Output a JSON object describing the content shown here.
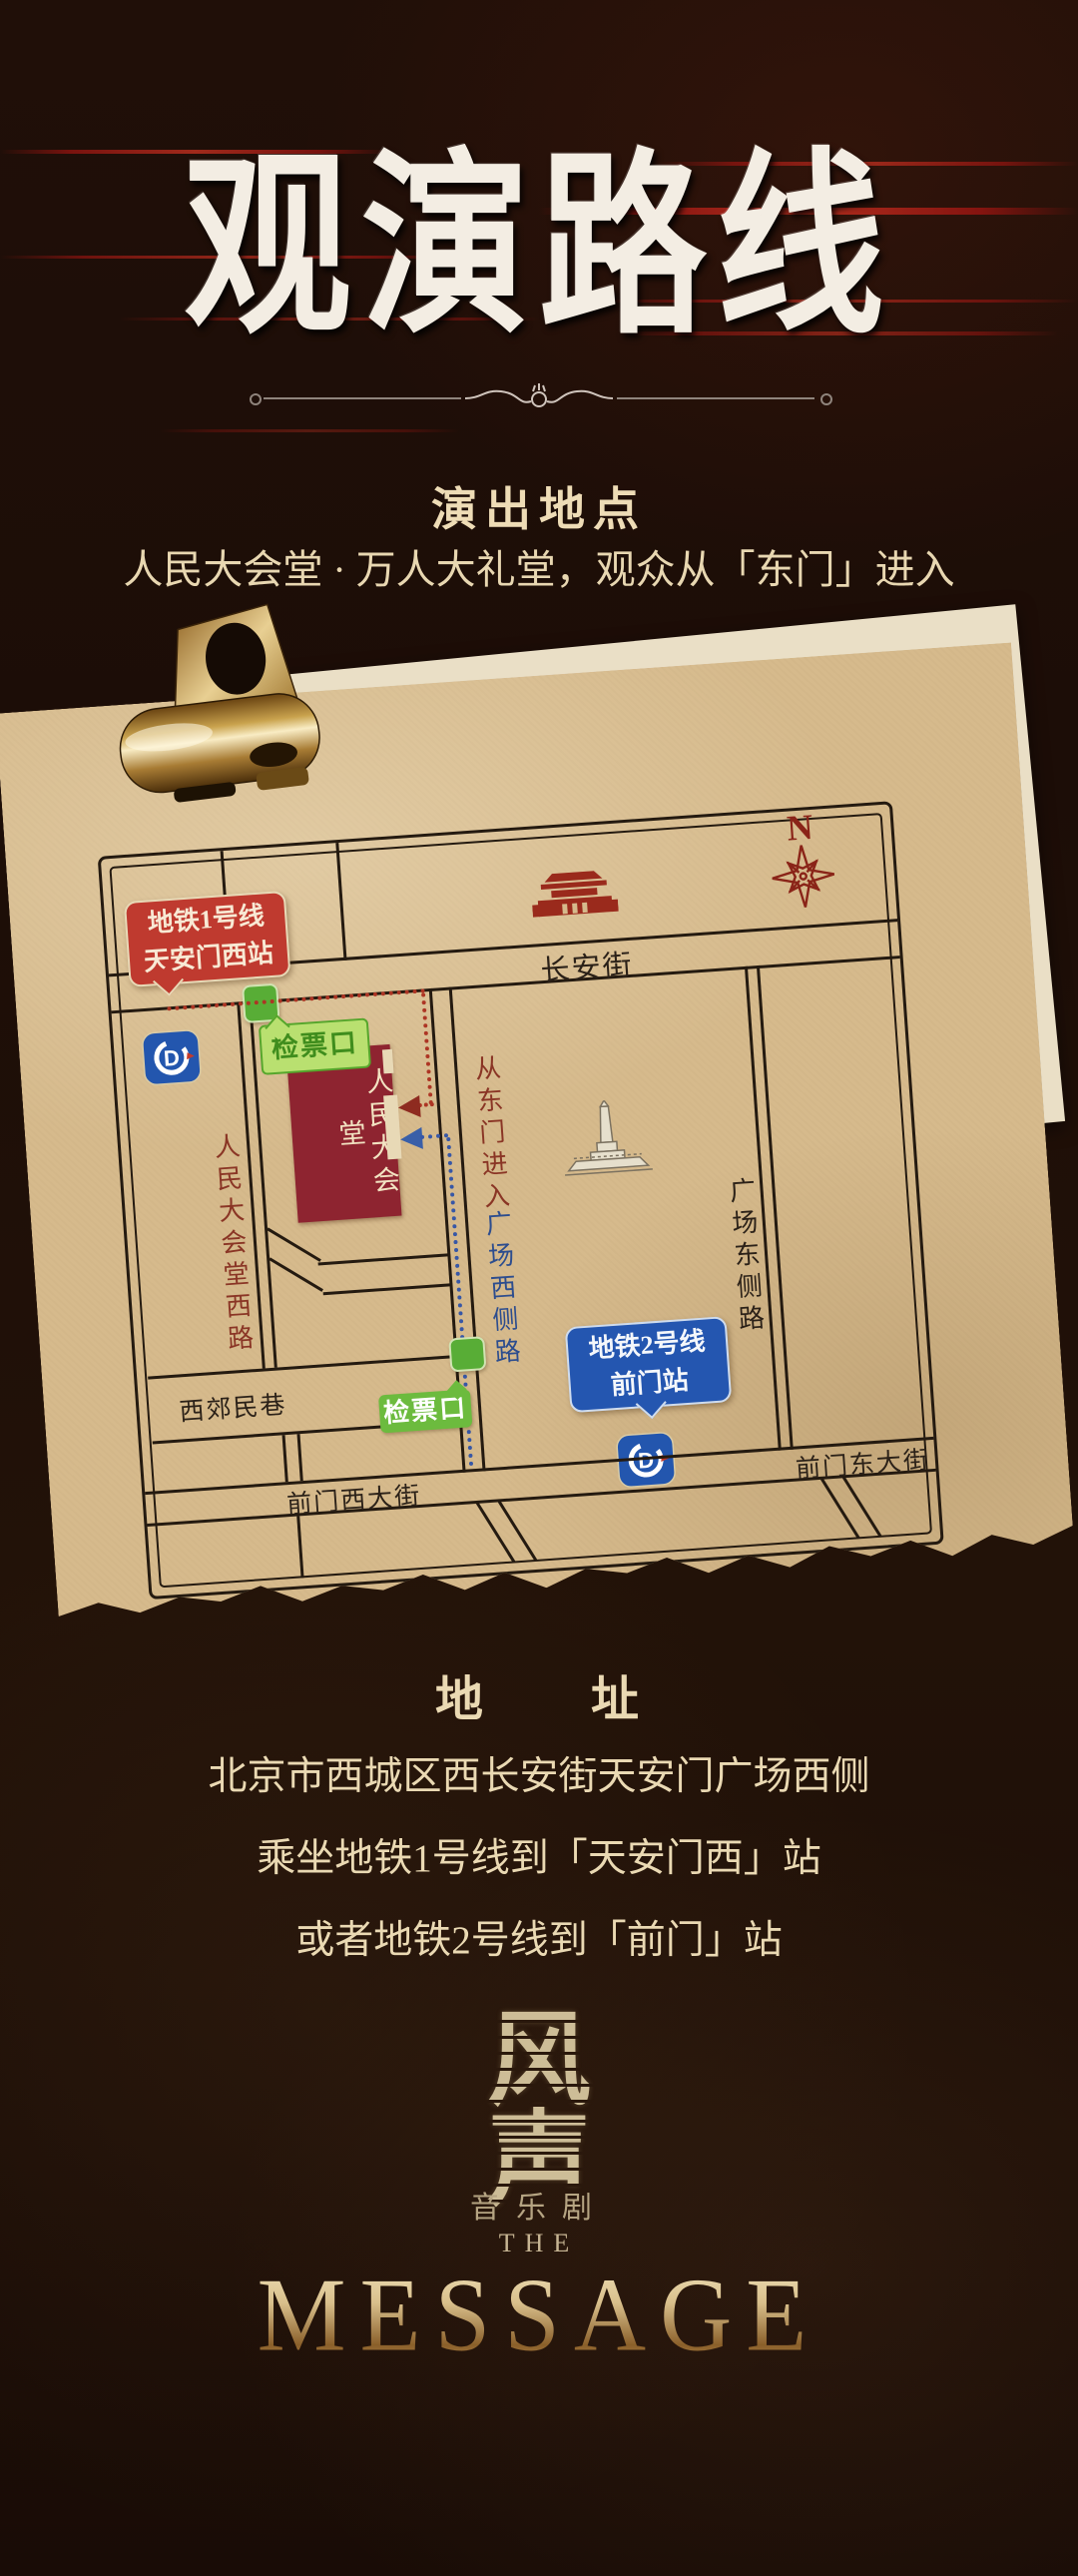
{
  "title": {
    "text": "观演路线"
  },
  "venue": {
    "heading": "演出地点",
    "line": "人民大会堂 · 万人大礼堂，观众从「东门」进入"
  },
  "map": {
    "compass": "N",
    "landmark_tiananmen": "天安门",
    "landmark_monument": "人民英雄纪念碑",
    "building": "人民大会堂",
    "entry_note": "从东门进入",
    "checkpoint_1": "检票口",
    "checkpoint_2": "检票口",
    "metro_line1_station": {
      "line": "地铁1号线",
      "station": "天安门西站"
    },
    "metro_line2_station": {
      "line": "地铁2号线",
      "station": "前门站"
    },
    "metro_logo_letter": "D",
    "streets": {
      "changanjie": "长安街",
      "renmindahuitang_xilu": "人民大会堂西路",
      "guangchang_xicelu": "广场西侧路",
      "guangchang_dongcelu": "广场东侧路",
      "xijiaominxiang": "西郊民巷",
      "qianmen_xidajie": "前门西大街",
      "qianmen_dongdajie": "前门东大街"
    },
    "colors": {
      "paper": "#d6ba8c",
      "road": "#241a10",
      "building_red": "#8e2430",
      "bubble_red": "#bf3a2f",
      "bubble_blue": "#2456b0",
      "marker_green": "#58ad36",
      "label_green_bg": "#b9e070",
      "label_green_text": "#3f8d1d",
      "compass_red": "#8a2418",
      "street_blue": "#2d4d8e",
      "street_darkred": "#8a3525",
      "metro_blue": "#2356ae",
      "route_red": "#ad3524",
      "route_blue": "#3757a6"
    }
  },
  "address": {
    "heading": "地　　址",
    "lines": [
      "北京市西城区西长安街天安门广场西侧",
      "乘坐地铁1号线到「天安门西」站",
      "或者地铁2号线到「前门」站"
    ]
  },
  "logo": {
    "char_top": "风",
    "char_bottom": "声",
    "genre": "音乐剧",
    "the": "THE",
    "name": "MESSAGE"
  }
}
